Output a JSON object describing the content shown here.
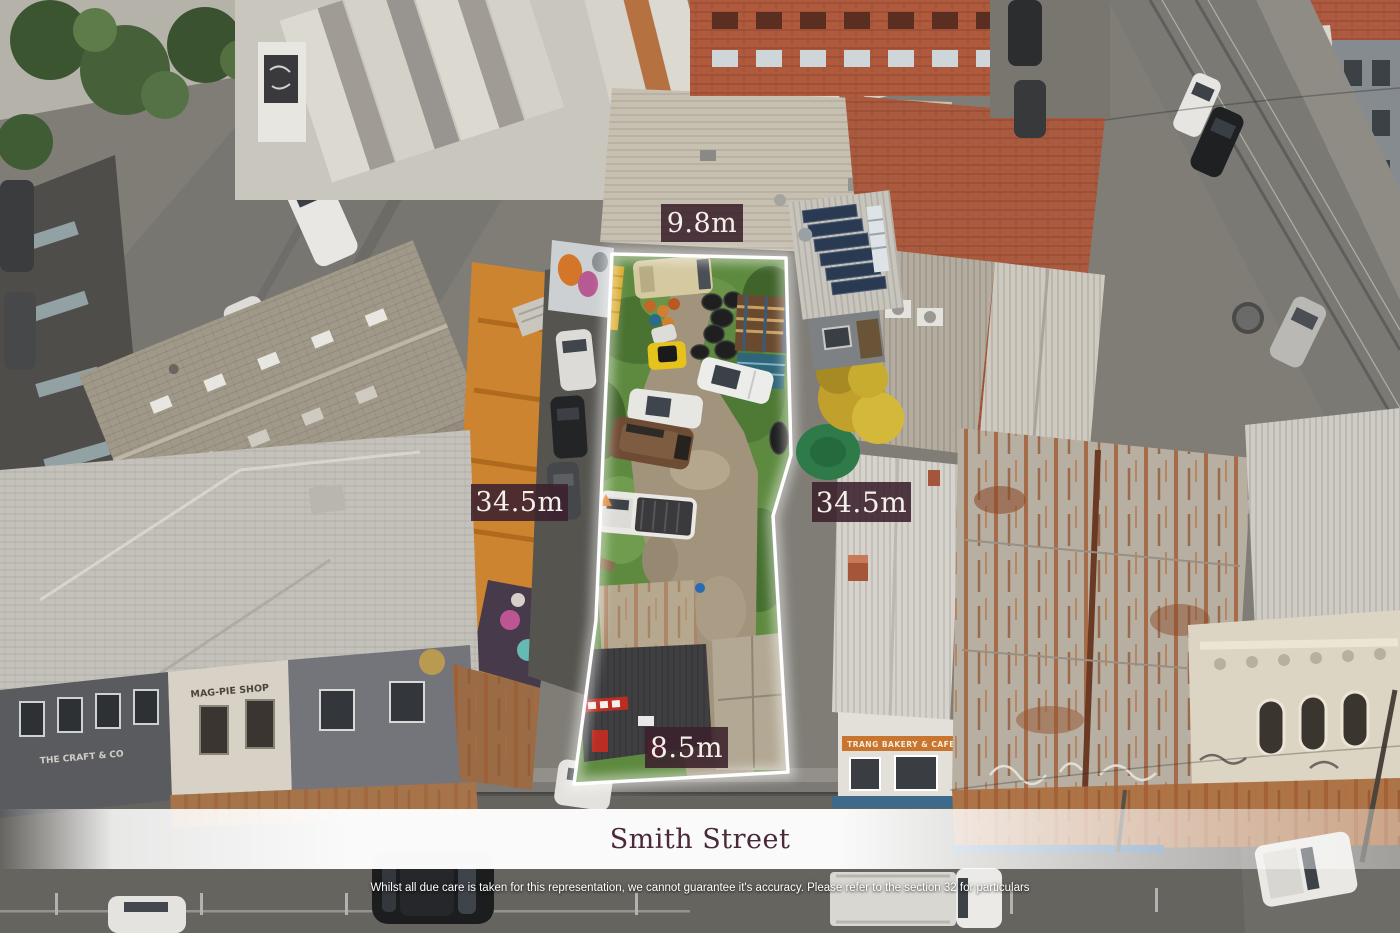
{
  "annotations": {
    "dimension_labels": {
      "top": "9.8m",
      "left": "34.5m",
      "right": "34.5m",
      "bottom": "8.5m"
    },
    "street_banner": {
      "text": "Smith Street"
    },
    "disclaimer": "Whilst all due care is taken for this representation, we cannot guarantee it's accuracy. Please refer to the section 32 for particulars",
    "colors": {
      "label_chip_background": "#3B212C",
      "label_text": "#F4EFEA",
      "street_text": "#4A2938",
      "banner": "#FFFFFF",
      "boundary_line": "#FFFFFF"
    }
  },
  "scene": {
    "shop_signs": {
      "magpie": "MAG-PIE SHOP",
      "craft": "THE CRAFT & CO",
      "bakery": "TRANG BAKERY & CAFE"
    }
  }
}
